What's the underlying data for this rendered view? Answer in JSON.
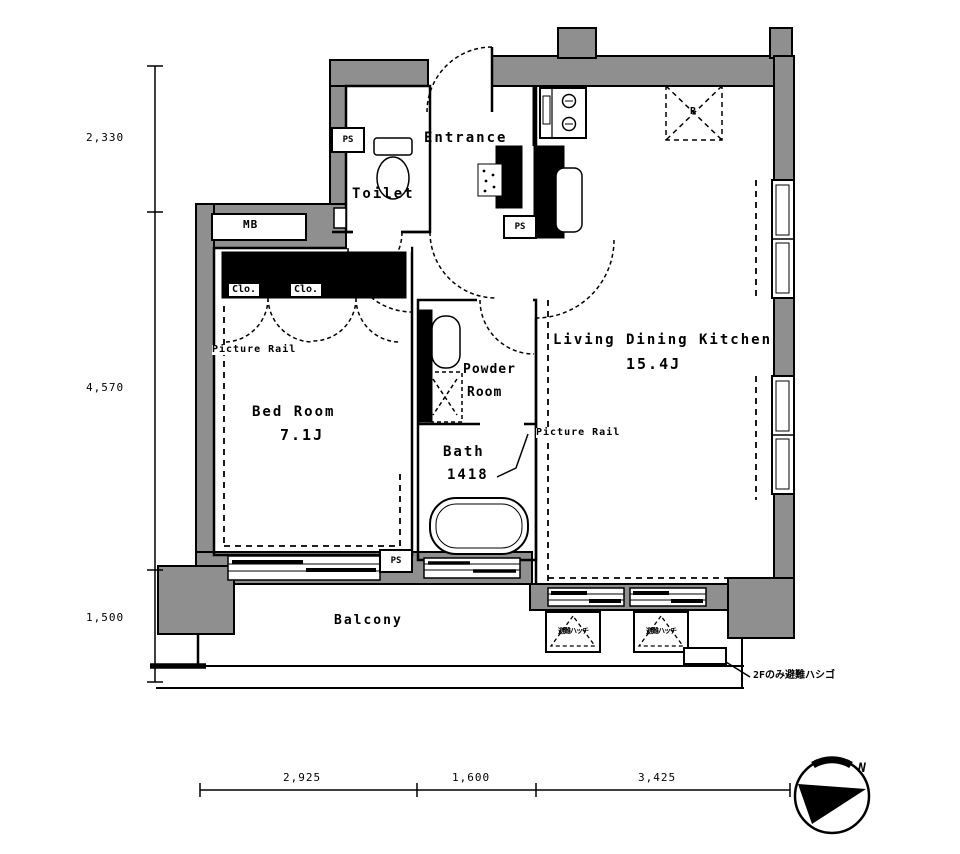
{
  "rooms": {
    "entrance": {
      "name": "Entrance"
    },
    "toilet": {
      "name": "Toilet"
    },
    "bedroom": {
      "name": "Bed Room",
      "size": "7.1J"
    },
    "ldk": {
      "name": "Living Dining Kitchen",
      "size": "15.4J"
    },
    "powder": {
      "line1": "Powder",
      "line2": "Room"
    },
    "bath": {
      "name": "Bath",
      "size": "1418"
    },
    "balcony": {
      "name": "Balcony"
    }
  },
  "fixtures": {
    "meter_box": "MB",
    "pipe_space": "PS",
    "closet": "Clo.",
    "picture_rail": "Picture Rail",
    "refrigerator": "R",
    "escape_hatch": "避難ハッチ"
  },
  "annotations": {
    "escape_ladder_note": "2Fのみ避難ハシゴ",
    "compass_north": "N"
  },
  "dimensions": {
    "left": [
      "2,330",
      "4,570",
      "1,500"
    ],
    "bottom": [
      "2,925",
      "1,600",
      "3,425"
    ]
  },
  "colors": {
    "wall_gray": "#8f8f8f",
    "line": "#000000",
    "background": "#ffffff"
  }
}
